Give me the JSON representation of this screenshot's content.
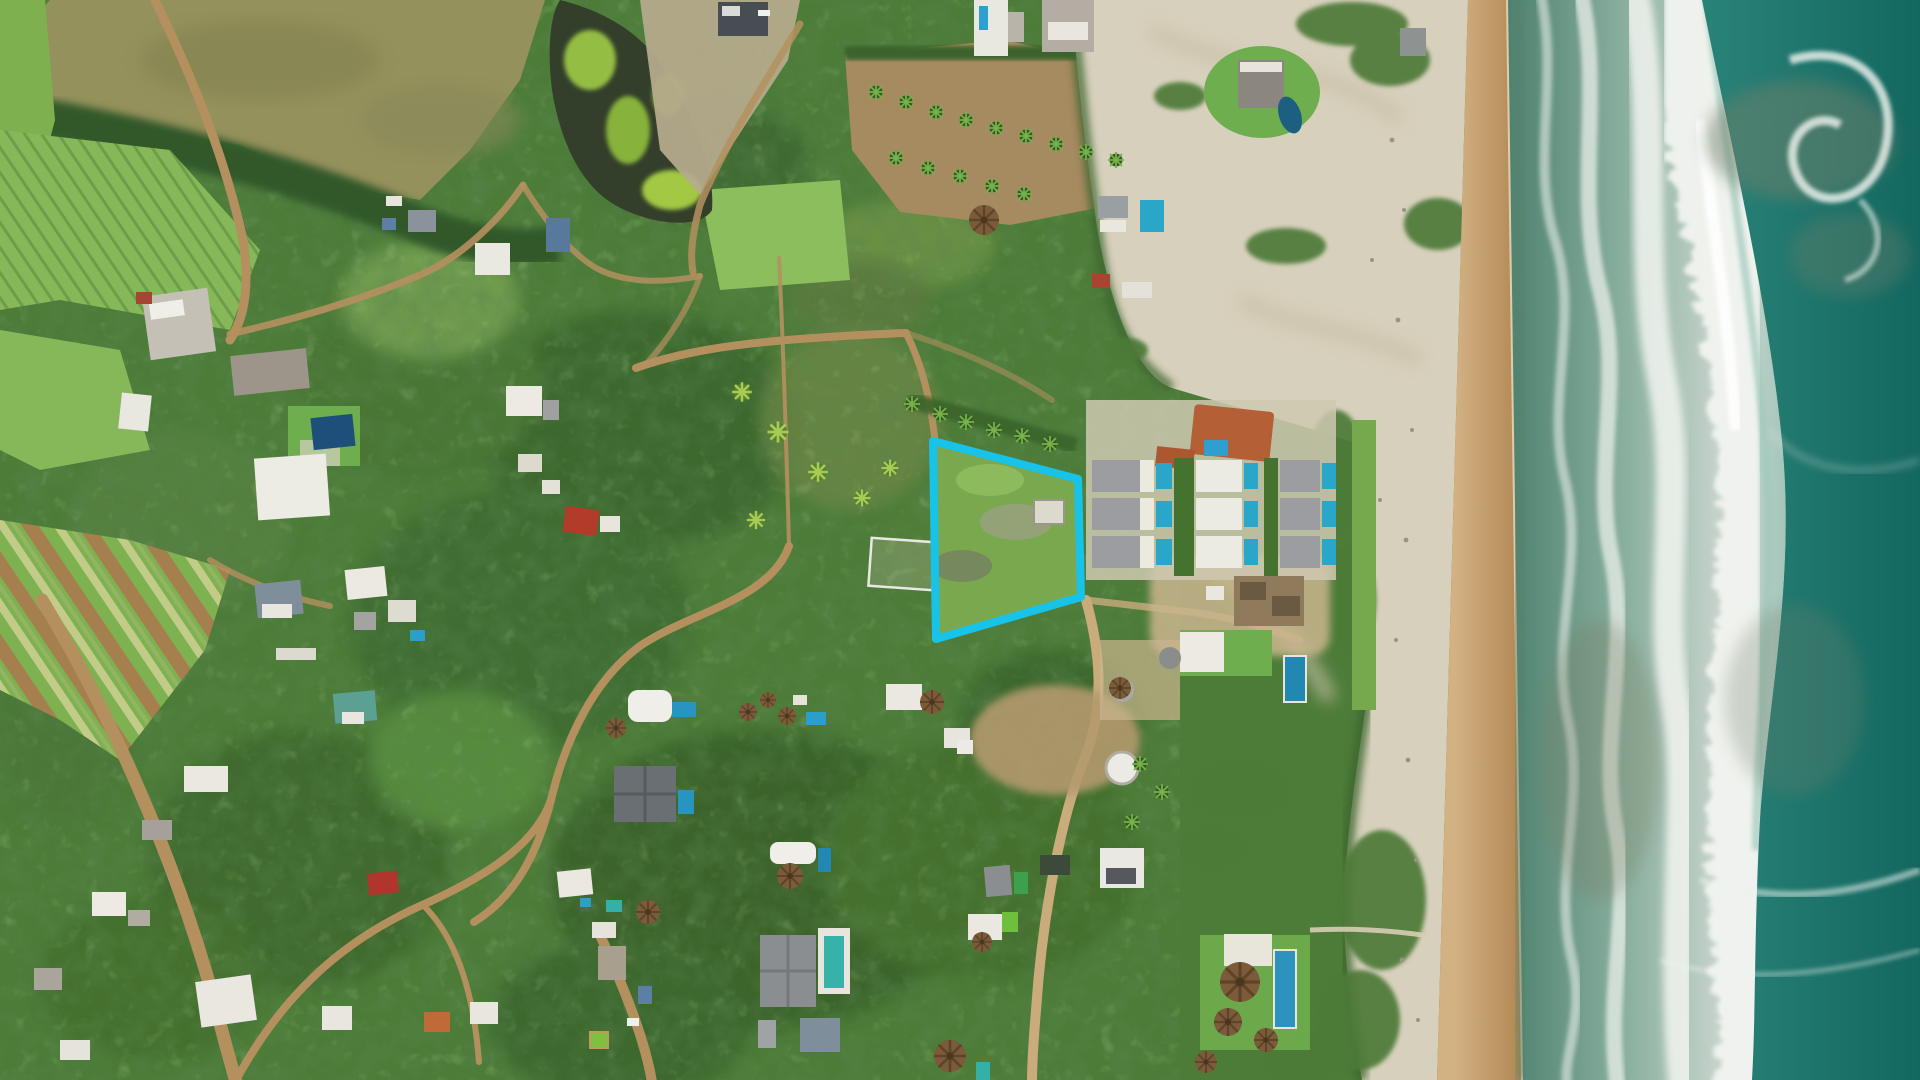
{
  "scene": {
    "type": "aerial-drone-photograph",
    "description": "Top-down drone photo of a beachfront community: dense green vegetation and farm strips on the left, scattered villas with pools and thatched palapas in the center, a resort row of villas with plunge pools near the shore, a wide sand beach and breaking Pacific surf along the right edge. A vacant lot is outlined with a thick cyan boundary.",
    "orientation": "shoreline runs vertically along the right side of the frame"
  },
  "annotation": {
    "label": "property-boundary",
    "polygon_points": "933,441 1078,479 1081,597 936,639",
    "stroke_color": "#18c3e9",
    "stroke_width_px": 8
  },
  "palette": {
    "ocean_deep": "#15706a",
    "ocean_sediment": "#70806a",
    "surf_shallow": "#4e8270",
    "surf_foam": "#eef1ec",
    "sand_dry_upper": "#d7d0bc",
    "sand_wet_tan": "#c09a66",
    "canopy_green": "#4d7c39",
    "canopy_dark": "#375f2a",
    "field_green": "#7eb251",
    "field_brown": "#a5804e",
    "pasture_olive": "#95915c",
    "dirt_road": "#b5905f",
    "pool_blue": "#29a3cc",
    "pool_teal": "#35b0a8",
    "pool_deep": "#1d4f7a",
    "roof_white": "#efeee8",
    "roof_gray": "#8f9193",
    "roof_terracotta": "#b45f35",
    "roof_blue": "#4c7ca8",
    "thatch_brown": "#7b5b39",
    "pond_water": "#333f2a",
    "pond_algae": "#a6d44a"
  },
  "features": {
    "pond": "algae-covered pond at top left",
    "orchard": "palm orchard rows on bare dirt, top center",
    "farmland": "diagonal crop strips of green and tilled brown soil, lower left",
    "resort": "3x3 grid of villas with plunge pools beside a terracotta-roof clubhouse",
    "beach": "white upper beach with dune scrub, golden wet-sand band at the waterline",
    "ocean": "wide white surf zone with foam streaks, teal open water with sediment swirls",
    "roads": "unpaved dirt tracks winding through the vegetation",
    "highlight": "vacant green lot outlined in cyan just inland of the resort row"
  }
}
